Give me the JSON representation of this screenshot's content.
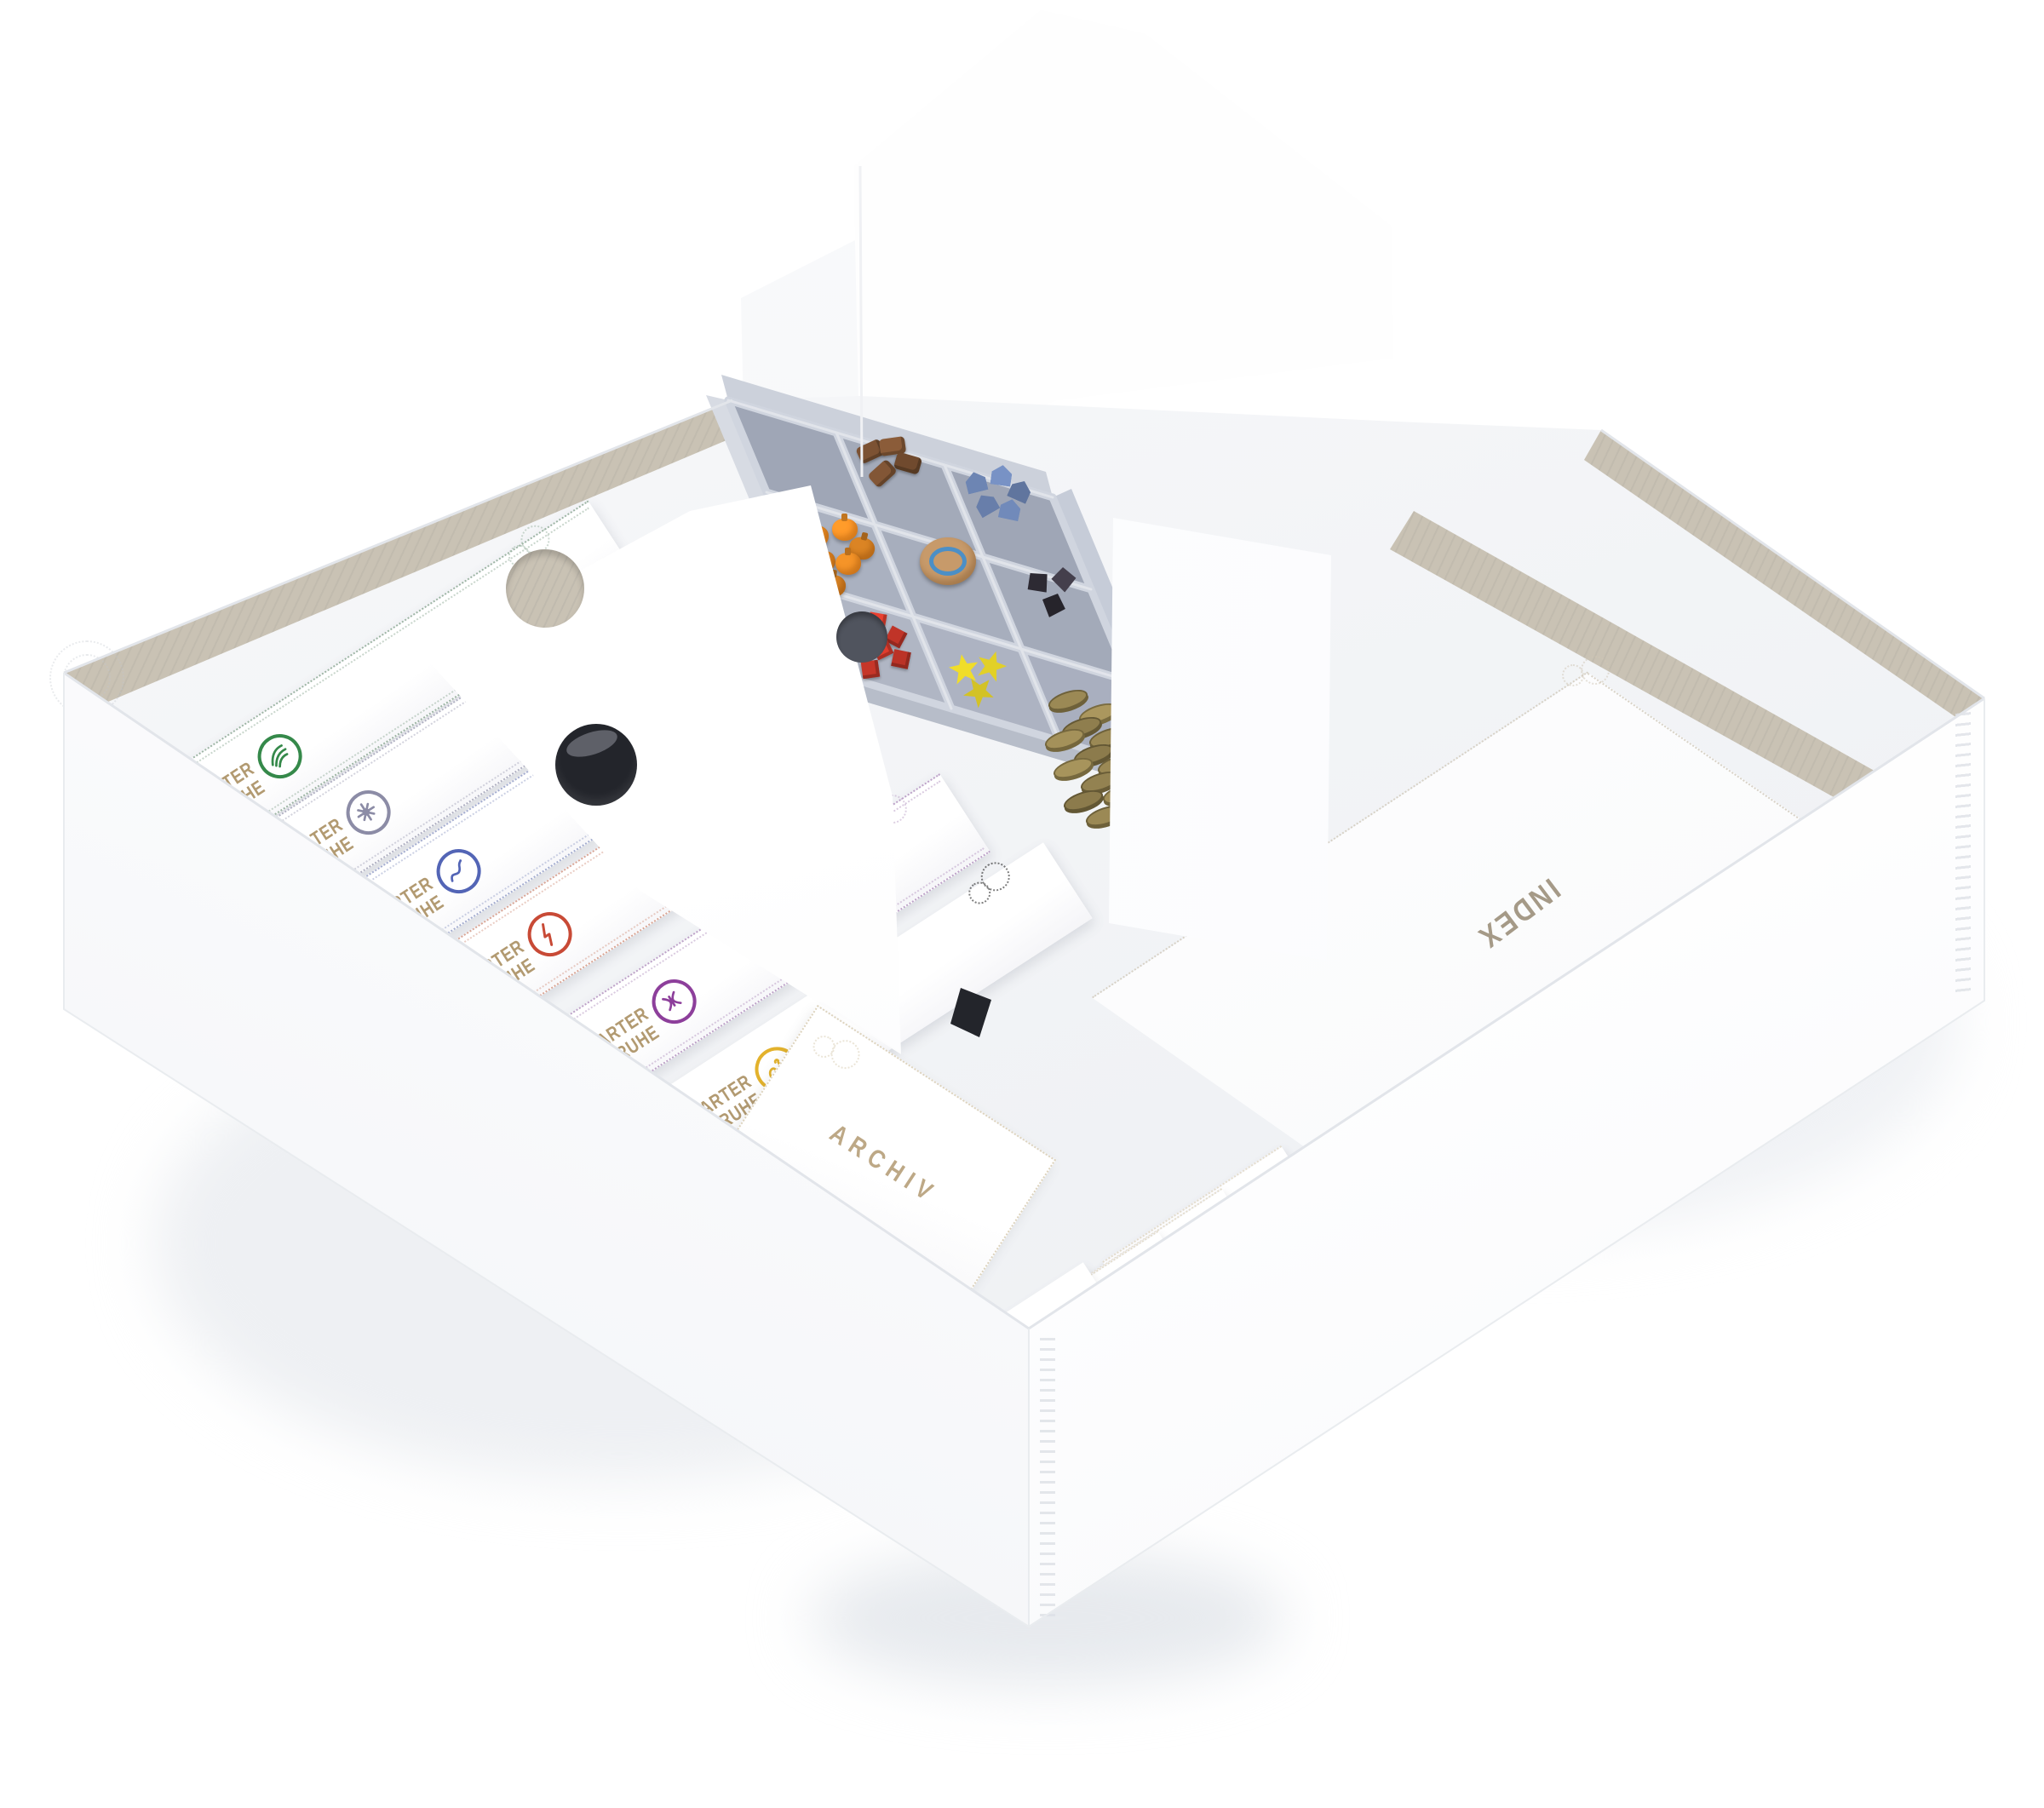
{
  "scene": {
    "description": "Open white board game storage box photographed at an angle, filled with white card organizer boxes and a gray tray of wooden game pieces",
    "background_color": "#ffffff"
  },
  "palette": {
    "box_white": "#fdfdfe",
    "chipboard": "#c9c2b4",
    "gold_text": "#b29a71",
    "tray_gray": "#bcc2cf",
    "ornament_gray": "#c9cdd6"
  },
  "charter_boxes": [
    {
      "name": "green",
      "line1": "CHARTER",
      "line2": "TRUHE",
      "icon": "leaf-icon",
      "color": "#35894a",
      "trim": "#9db5a4"
    },
    {
      "name": "slate",
      "line1": "CHARTER",
      "line2": "TRUHE",
      "icon": "flower-icon",
      "color": "#8c8ca6",
      "trim": "#b0b0c2"
    },
    {
      "name": "blue",
      "line1": "CHARTER",
      "line2": "TRUHE",
      "icon": "snake-icon",
      "color": "#5365b6",
      "trim": "#a3accf"
    },
    {
      "name": "red",
      "line1": "CHARTER",
      "line2": "TRUHE",
      "icon": "lightning-icon",
      "color": "#c84a36",
      "trim": "#d9a595"
    },
    {
      "name": "purple",
      "line1": "CHARTER",
      "line2": "TRUHE",
      "icon": "moth-icon",
      "color": "#8d3f9b",
      "trim": "#bda2c8"
    },
    {
      "name": "yellow",
      "line1": "CHARTER",
      "line2": "TRUHE",
      "icon": "swan-icon",
      "color": "#e3b22c",
      "trim": "#ddc避"
    }
  ],
  "archive_box": {
    "label": "ARCHIV"
  },
  "index_board": {
    "label": "INDEX"
  },
  "small_boxes": [
    {
      "numeral": "I"
    },
    {
      "numeral": "II"
    },
    {
      "numeral": "III"
    },
    {
      "numeral": "II"
    }
  ],
  "tray": {
    "color": "#bcc2cf",
    "compartments": [
      {
        "name": "brown-goods",
        "piece_color": "#7c5233",
        "count": 4
      },
      {
        "name": "blue-buildings",
        "piece_color": "#6d85b3",
        "count": 5
      },
      {
        "name": "orange-pumpkins",
        "piece_color": "#ee9027",
        "count": 6
      },
      {
        "name": "wooden-disc",
        "piece_color": "#c79a6a",
        "accent_color": "#3e8ed0",
        "count": 1
      },
      {
        "name": "black-pieces",
        "piece_color": "#2d2a33",
        "count": 3
      },
      {
        "name": "red-cubes",
        "piece_color": "#d53a2c",
        "count": 7
      },
      {
        "name": "yellow-tokens",
        "piece_color": "#f0dd2a",
        "count": 3
      },
      {
        "name": "gold-coins",
        "piece_color": "#9b8955",
        "accent_color": "#6e613a",
        "count": 12
      }
    ]
  }
}
